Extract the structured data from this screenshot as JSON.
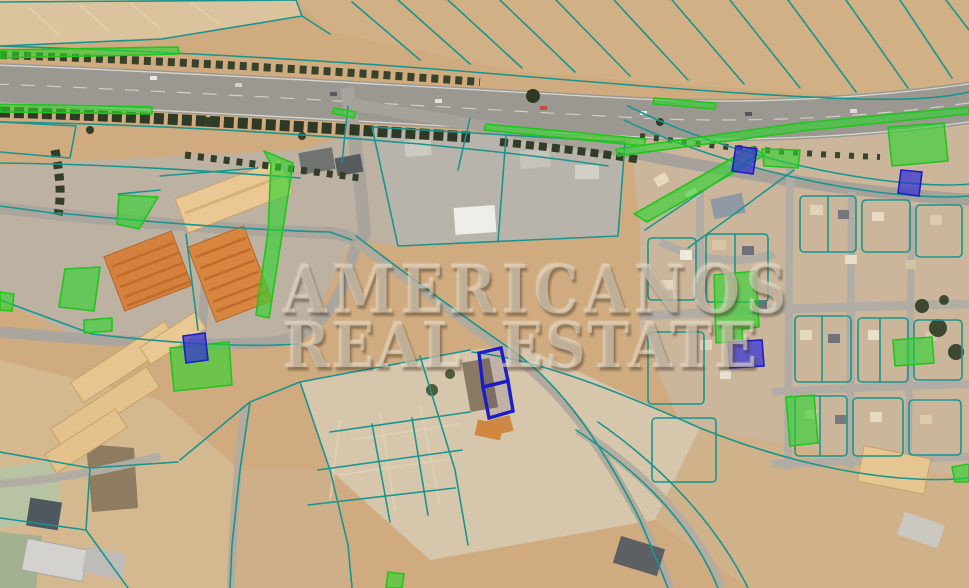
{
  "watermark": {
    "line1": "AMERICANOS",
    "line2": "REAL ESTATE"
  },
  "overlay_colors": {
    "boundary_line": "#1a958d",
    "green_parcel_fill": "#2fd32f",
    "green_parcel_stroke": "#23c41c",
    "blue_parcel_fill": "#3232d2",
    "blue_parcel_stroke": "#1d1dc6"
  },
  "parcels": {
    "green": [
      {
        "points": "0,50 178,47 179,54 0,58"
      },
      {
        "points": "0,104 152,107 152,114 0,112"
      },
      {
        "points": "334,108 356,112 354,118 332,113"
      },
      {
        "points": "486,124 646,139 644,146 484,130"
      },
      {
        "points": "616,149 800,123 969,107 969,114 802,131 618,156"
      },
      {
        "points": "654,98 716,103 715,109 653,104"
      },
      {
        "points": "634,214 752,147 765,155 647,222"
      },
      {
        "points": "762,149 800,150 798,168 764,166"
      },
      {
        "points": "119,195 158,197 139,229 117,224"
      },
      {
        "points": "264,151 293,163 282,235 269,318 256,315 268,232 271,164"
      },
      {
        "points": "65,269 100,267 94,311 59,307"
      },
      {
        "points": "84,320 112,318 112,331 84,333"
      },
      {
        "points": "170,348 229,342 232,385 174,391"
      },
      {
        "points": "714,275 756,271 759,327 742,329 743,341 716,343"
      },
      {
        "points": "888,127 944,123 948,161 892,166"
      },
      {
        "points": "786,397 814,395 818,443 790,446"
      },
      {
        "points": "893,340 932,337 934,363 895,366"
      },
      {
        "points": "952,467 969,464 969,482 955,482"
      },
      {
        "points": "388,572 404,574 402,588 386,588"
      },
      {
        "points": "0,292 14,294 12,311 0,310"
      }
    ],
    "blue_filled": [
      {
        "points": "183,336 205,333 208,360 186,363"
      },
      {
        "points": "736,146 757,149 753,174 732,171"
      },
      {
        "points": "901,170 922,172 919,196 898,193"
      },
      {
        "points": "728,342 762,340 764,366 730,368"
      }
    ],
    "blue_outline": [
      {
        "points": "479,353 501,348 508,381 483,387"
      },
      {
        "points": "483,387 508,381 513,411 489,418"
      }
    ]
  }
}
